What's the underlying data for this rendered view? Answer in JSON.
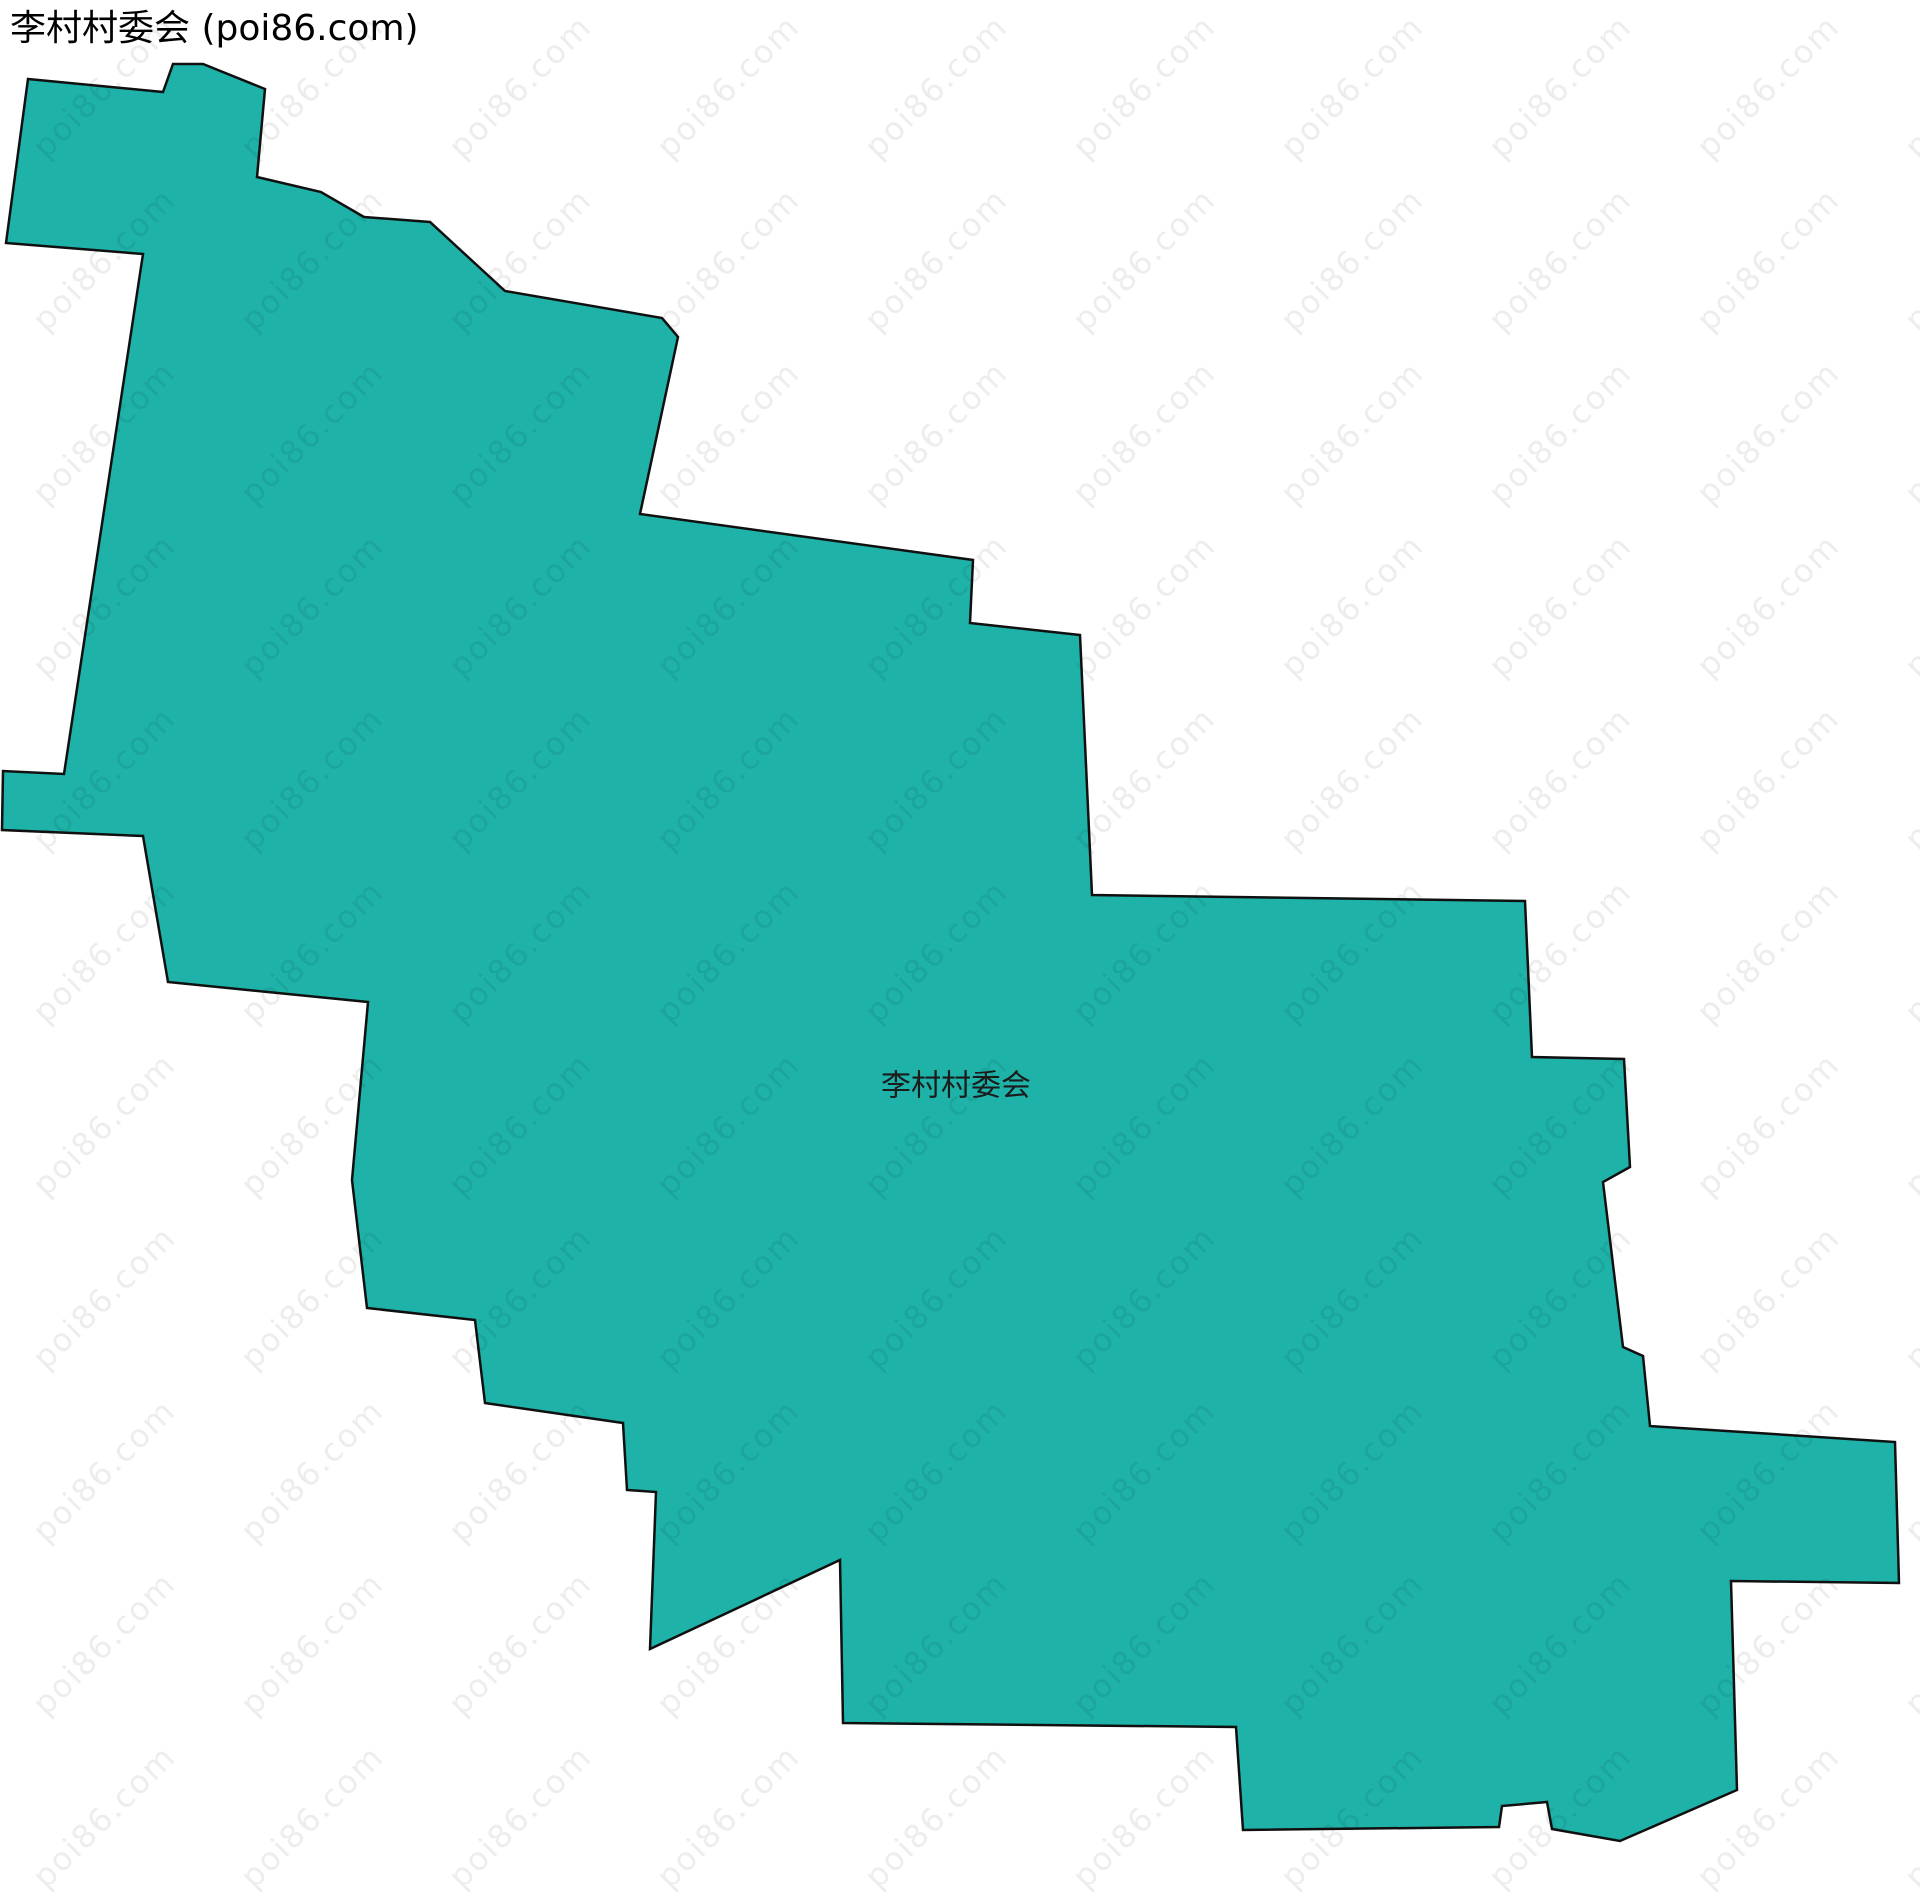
{
  "header": {
    "title": "李村村委会 (poi86.com)"
  },
  "map": {
    "region_label": "李村村委会",
    "label_position": {
      "x": 956,
      "y": 1086
    },
    "fill_color": "#1eb2a8",
    "stroke_color": "#101010",
    "stroke_width": 2.5,
    "background_color": "#ffffff",
    "polygon_points": [
      [
        28,
        79
      ],
      [
        163,
        92
      ],
      [
        173,
        64
      ],
      [
        203,
        64
      ],
      [
        265,
        89
      ],
      [
        257,
        177
      ],
      [
        321,
        192
      ],
      [
        364,
        217
      ],
      [
        430,
        222
      ],
      [
        505,
        291
      ],
      [
        662,
        318
      ],
      [
        678,
        337
      ],
      [
        640,
        514
      ],
      [
        973,
        560
      ],
      [
        970,
        623
      ],
      [
        1080,
        635
      ],
      [
        1092,
        895
      ],
      [
        1525,
        901
      ],
      [
        1532,
        1057
      ],
      [
        1624,
        1059
      ],
      [
        1630,
        1167
      ],
      [
        1603,
        1182
      ],
      [
        1623,
        1347
      ],
      [
        1643,
        1356
      ],
      [
        1650,
        1426
      ],
      [
        1895,
        1442
      ],
      [
        1899,
        1583
      ],
      [
        1731,
        1581
      ],
      [
        1737,
        1790
      ],
      [
        1620,
        1841
      ],
      [
        1552,
        1829
      ],
      [
        1547,
        1802
      ],
      [
        1502,
        1806
      ],
      [
        1499,
        1827
      ],
      [
        1243,
        1830
      ],
      [
        1236,
        1727
      ],
      [
        843,
        1723
      ],
      [
        840,
        1560
      ],
      [
        650,
        1649
      ],
      [
        656,
        1492
      ],
      [
        627,
        1490
      ],
      [
        623,
        1423
      ],
      [
        485,
        1403
      ],
      [
        475,
        1320
      ],
      [
        367,
        1308
      ],
      [
        352,
        1180
      ],
      [
        368,
        1002
      ],
      [
        168,
        982
      ],
      [
        143,
        836
      ],
      [
        2,
        830
      ],
      [
        3,
        771
      ],
      [
        64,
        774
      ],
      [
        143,
        254
      ],
      [
        6,
        243
      ]
    ]
  },
  "watermark": {
    "text": "poi86.com",
    "color": "#000000",
    "opacity": 0.07,
    "font_size": 32,
    "angle_deg": -45,
    "tile": {
      "width": 208,
      "height": 173
    }
  }
}
